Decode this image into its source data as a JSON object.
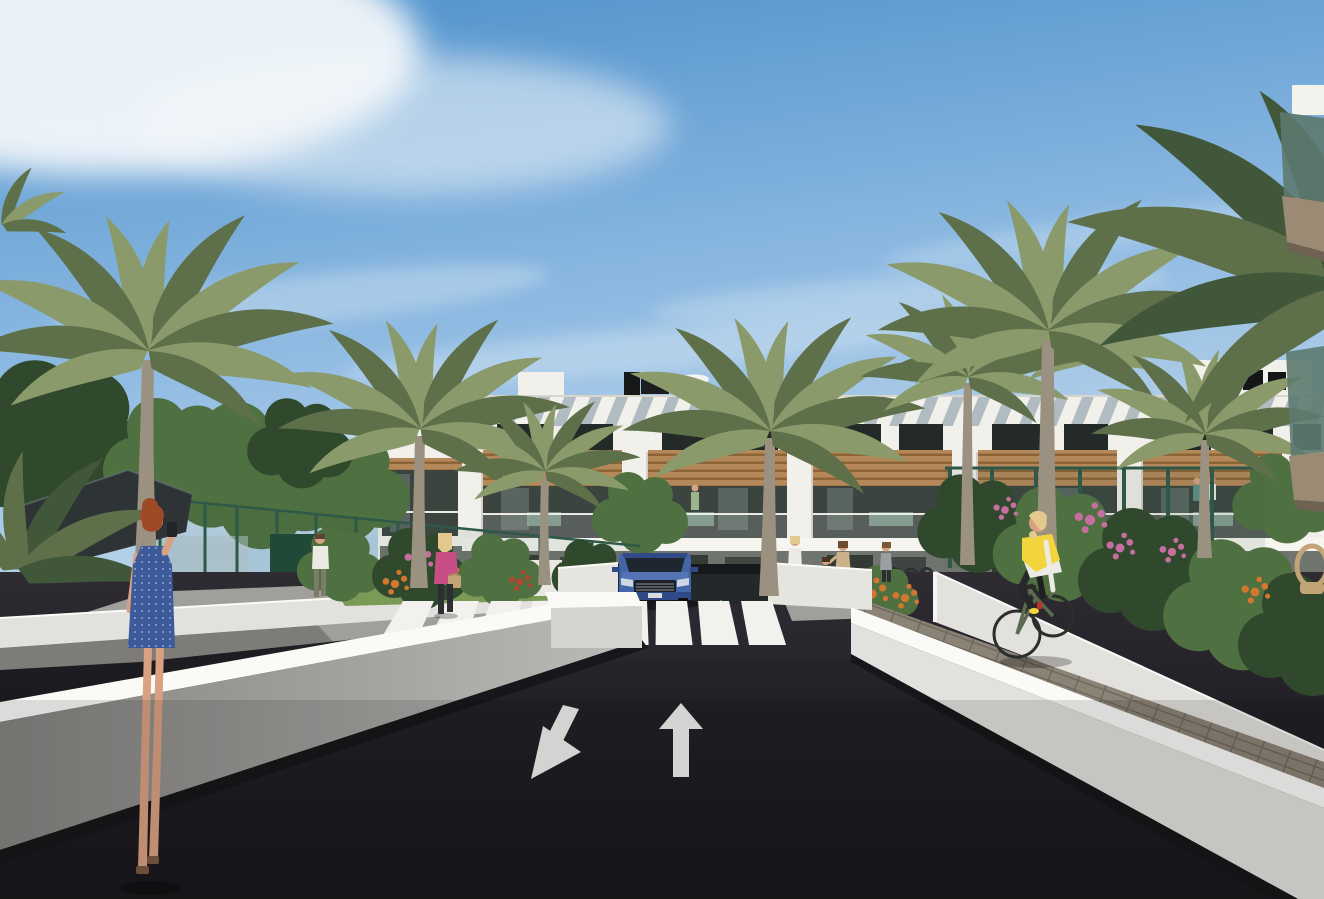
{
  "scene": {
    "type": "architectural-render",
    "description": "3D exterior rendering of a modern white Mediterranean apartment complex: a dark two-way asphalt road with painted white lane arrows leads to a pedestrian crosswalk and an underground parking ramp where a blue SUV emerges; white low retaining walls flank the road; palm trees, leafy trees, green mesh fences, flowering gardens; pedestrians including a red-haired woman in a blue dress taking a photo, a blonde woman in pink with a handbag, a man in a white shirt, a family group, and a cyclist in a yellow vest on a paved path; three-storey white buildings with timber accents, louvered top floor, balconies with residents and rooftop parasols under a blue sky with wispy clouds",
    "width_px": 1324,
    "height_px": 899,
    "visible_text": ""
  },
  "palette": {
    "sky_top": "#4e90cb",
    "sky_mid": "#8fbbe2",
    "sky_low": "#cadded",
    "cloud": "#f3f7fa",
    "facade": "#f2f0ea",
    "facade_shade": "#dcd9d0",
    "louver_shadow": "#8fa0ac",
    "wood": "#b5885a",
    "wood_dark": "#8d6436",
    "window_dark": "#232a28",
    "balcony_glass": "#3c4440",
    "glass_reflection": "#8fa39b",
    "ground_floor": "#70746f",
    "door_dark": "#333a36",
    "asphalt": "#232127",
    "asphalt_light": "#2c2a30",
    "road_marking": "#f2f1ee",
    "wall_sun_top": "#fafaf7",
    "wall_sun_face": "#e3e1dd",
    "wall_shade_face": "#a3a19e",
    "wall_base_dark": "#17161a",
    "paver": "#8c8377",
    "paver_joint": "#6f675c",
    "path_gray": "#a19f9b",
    "path_shadow": "#6b6a67",
    "grass": "#7a9a55",
    "foliage": "#4f7040",
    "foliage_dark": "#30492c",
    "palm_light": "#8a9a6b",
    "palm_dark": "#5d7049",
    "palm_shadow": "#41573a",
    "trunk": "#9a9181",
    "fence_green": "#2e5847",
    "gate_green": "#1f4a38",
    "canopy": "#2e3336",
    "car_blue": "#4465a8",
    "car_blue_dark": "#2f4a85",
    "car_glass": "#1e2630",
    "chrome": "#b9c2cc",
    "skin": "#d9a182",
    "hair_red": "#9e4a26",
    "hair_blonde": "#e4c98f",
    "dress_blue": "#3d5a9b",
    "pink_top": "#c84f86",
    "vest_yellow": "#f2d53c",
    "white_cloth": "#eceae4",
    "pants_dark": "#2c2f33",
    "teal_top": "#5b8f86",
    "bike_green": "#5a6b4f",
    "bag_tan": "#c2a476",
    "flower_pink": "#c76ea0",
    "flower_orange": "#d2772f",
    "flower_red": "#b8452f",
    "glass_green": "#5d7a70",
    "slab_tan": "#9b8a74"
  },
  "objects": [
    {
      "id": "main-apartment-building",
      "label": "white 3-storey apartment block with louvered top floor, timber fascia, balconies"
    },
    {
      "id": "parking-ramp",
      "label": "underground parking ramp entrance"
    },
    {
      "id": "suv-car",
      "label": "blue SUV exiting ramp"
    },
    {
      "id": "crosswalk",
      "label": "white zebra crosswalk"
    },
    {
      "id": "lane-arrow-straight",
      "label": "white straight-ahead lane arrow"
    },
    {
      "id": "lane-arrow-left",
      "label": "white toward-viewer lane arrow"
    },
    {
      "id": "pedestrian-blue-dress",
      "label": "red-haired woman in blue dotted dress taking photo"
    },
    {
      "id": "pedestrian-pink-top",
      "label": "blonde woman in pink with tan handbag"
    },
    {
      "id": "pedestrian-white-shirt",
      "label": "man in white shirt walking away"
    },
    {
      "id": "cyclist",
      "label": "woman in yellow vest riding green bicycle"
    },
    {
      "id": "family-group",
      "label": "adults, child and a bicycle near building entrance"
    },
    {
      "id": "shade-canopy",
      "label": "dark shade sail structure"
    },
    {
      "id": "mesh-fence",
      "label": "green mesh sports-court fencing"
    },
    {
      "id": "palm-trees",
      "label": "tall date palms"
    },
    {
      "id": "rooftop-parasols",
      "label": "white rooftop parasols"
    },
    {
      "id": "foreground-balconies",
      "label": "near building balconies with green glass railings"
    },
    {
      "id": "wicker-chair",
      "label": "rattan chair on right terrace"
    }
  ]
}
